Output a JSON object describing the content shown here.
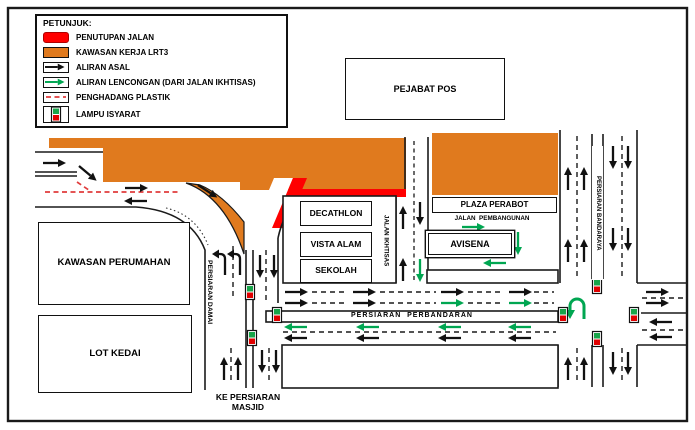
{
  "colors": {
    "orange": "#E07A1E",
    "red": "#FF0000",
    "green": "#00A651",
    "barrier": "#E03C3C"
  },
  "legend": {
    "title": "PETUNJUK:",
    "items": [
      {
        "id": "closure",
        "label": "PENUTUPAN JALAN"
      },
      {
        "id": "workzone",
        "label": "KAWASAN KERJA LRT3"
      },
      {
        "id": "original-flow",
        "label": "ALIRAN ASAL"
      },
      {
        "id": "diverted-flow",
        "label": "ALIRAN LENCONGAN (DARI JALAN IKHTISAS)"
      },
      {
        "id": "plastic-barrier",
        "label": "PENGHADANG PLASTIK"
      },
      {
        "id": "traffic-light",
        "label": "LAMPU ISYARAT"
      }
    ]
  },
  "places": {
    "pejabat_pos": "PEJABAT POS",
    "kawasan_perumahan": "KAWASAN PERUMAHAN",
    "lot_kedai": "LOT KEDAI",
    "decathlon": "DECATHLON",
    "vista_alam": "VISTA ALAM",
    "sekolah": "SEKOLAH",
    "plaza_perabot": "PLAZA PERABOT",
    "avisena": "AVISENA"
  },
  "roads": {
    "jalan_ikhtisas": "JALAN IKHTISAS",
    "jalan_pembangunan": "JALAN  PEMBANGUNAN",
    "persiaran_damai": "PERSIARAN DAMAI",
    "persiaran_bandaraya": "PERSIARAN BANDARAYA",
    "persiaran_perbandaran": "PERSIARAN  PERBANDARAN",
    "ke_persiaran_masjid": "KE PERSIARAN\nMASJID"
  }
}
